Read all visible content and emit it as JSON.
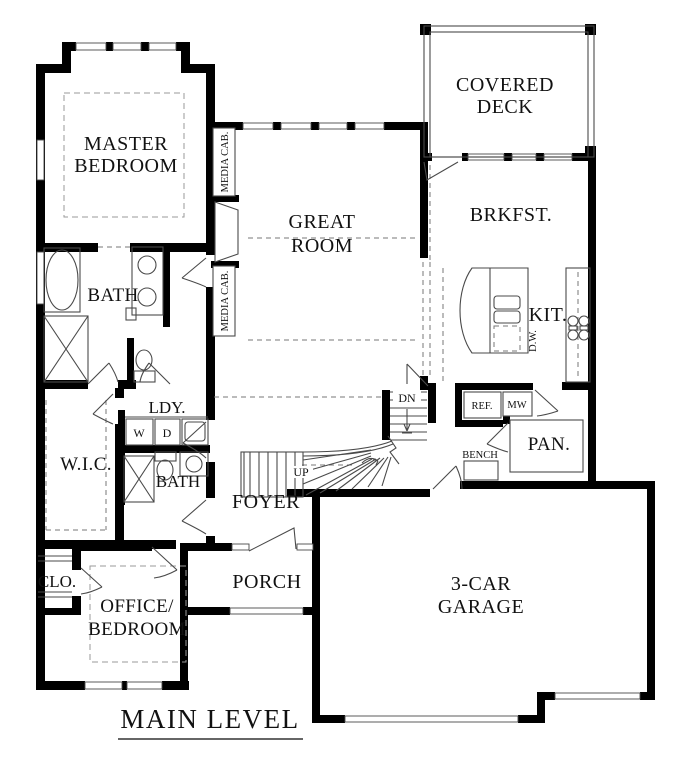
{
  "meta": {
    "plan_title": "MAIN LEVEL"
  },
  "rooms": {
    "master_bedroom": {
      "line1": "MASTER",
      "line2": "BEDROOM"
    },
    "great_room": {
      "line1": "GREAT",
      "line2": "ROOM"
    },
    "covered_deck": {
      "line1": "COVERED",
      "line2": "DECK"
    },
    "breakfast": {
      "label": "BRKFST."
    },
    "kitchen": {
      "label": "KIT."
    },
    "pantry": {
      "label": "PAN."
    },
    "master_bath": {
      "label": "BATH"
    },
    "hall_bath": {
      "label": "BATH"
    },
    "laundry": {
      "label": "LDY."
    },
    "walk_in_closet": {
      "label": "W.I.C."
    },
    "closet": {
      "label": "CLO."
    },
    "office_bedroom": {
      "line1": "OFFICE/",
      "line2": "BEDROOM"
    },
    "foyer": {
      "label": "FOYER"
    },
    "porch": {
      "label": "PORCH"
    },
    "garage": {
      "line1": "3-CAR",
      "line2": "GARAGE"
    }
  },
  "fixtures": {
    "media_cab_upper": "MEDIA CAB.",
    "media_cab_lower": "MEDIA CAB.",
    "dishwasher": "D.W.",
    "refrigerator": "REF.",
    "microwave": "MW",
    "washer": "W",
    "dryer": "D",
    "bench": "BENCH"
  },
  "stairs": {
    "down": "DN",
    "up": "UP"
  },
  "colors": {
    "wall": "#000000",
    "fixture_line": "#4a4a4a",
    "dash_line": "#9a9a9a",
    "background": "#ffffff",
    "text": "#111111"
  }
}
